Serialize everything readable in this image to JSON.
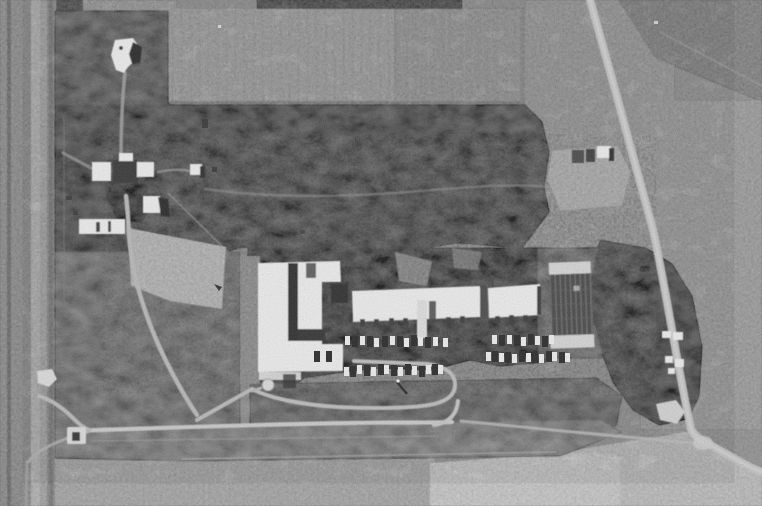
{
  "meta": {
    "kind": "black-and-white vertical aerial photograph",
    "subject": "rural installation with building complex, access roads, fields and a diagonal highway",
    "width_px": 762,
    "height_px": 506
  },
  "palette": {
    "base_field": "#8c8c8c",
    "left_margin": "#7d7d7d",
    "tilled_field": "#949494",
    "tilled_field_east": "#898989",
    "top_right_corner": "#757575",
    "scrub": "#474747",
    "scrub_light": "#545454",
    "building_ground": "#3e3e3e",
    "grass_west": "#656565",
    "grass_band": "#717171",
    "plowed_left": "#999999",
    "plowed_bright": "#bcbcbc",
    "plowed_right": "#b0b0b0",
    "cleared": "#a6a6a6",
    "pad": "#9b9b9b",
    "road": "#c6c6c6",
    "highway": "#bdbdbd",
    "white": "#ececec",
    "shadow": "#1c1c1c",
    "court_dark": "#383838",
    "court_bar": "#d2d2d2"
  },
  "features": {
    "photo": "black-and-white aerial photograph, no visible text",
    "water_tower": "white water tower with dark shadow, upper left",
    "north_field": "large cultivated field with faint vertical plough lines, top centre",
    "scrub_belt": "dark belt of scrub and trees across the upper middle",
    "west_compound": "cluster of small white buildings with shadows, left of centre",
    "cleared_patch": "light cleared ground below the west compound",
    "main_building": "large white L-shaped building with dark internal shadows, centre",
    "long_buildings": "two long white-roofed buildings east of the main building",
    "parking_rows": "rows of light and dark vehicles parked south of the buildings",
    "storage_tank": "small round white tank beside the parking loop",
    "loop_drive": "looping driveway with U-turn serving the parking rows",
    "entrance_road": "east-west entrance road along the south side with gate structure at its west end",
    "court": "rectangular court or bleacher structure with white end bars",
    "tree_grove": "dark tree grove in the south-east quadrant with small white sheds",
    "ne_compound": "small fenced pad with two buildings, upper right",
    "highway": "light diagonal highway from top centre to lower right, bending east near the bottom",
    "south_fields": "light ploughed fields along the bottom edge",
    "west_track": "vertical track and fence lines along the left edge"
  },
  "vehicles": {
    "car_w": 5,
    "car_h": 9,
    "truck_w": 6,
    "truck_h": 11,
    "white": "#eeeeee",
    "dark": "#161616",
    "rows": [
      {
        "y": 337,
        "white_x": [
          345,
          360,
          374,
          390,
          404,
          418,
          433,
          443
        ],
        "dark_x": [
          352,
          367,
          382,
          397,
          411,
          425
        ]
      },
      {
        "y": 366,
        "white_x": [
          344,
          357,
          371,
          384,
          398,
          412,
          426,
          438
        ],
        "dark_x": [
          350,
          364,
          378,
          391,
          405,
          419,
          432
        ]
      },
      {
        "y": 353,
        "white_x": [
          486,
          499,
          512,
          526,
          539,
          552,
          565
        ],
        "dark_x": [
          492,
          505,
          519,
          532,
          546,
          559
        ]
      },
      {
        "y": 336,
        "white_x": [
          492,
          507,
          521,
          535,
          549
        ],
        "dark_x": [
          499,
          514,
          528,
          542
        ]
      },
      {
        "y": 351,
        "white_x": [
          308,
          320,
          332
        ],
        "dark_x": [
          314,
          326
        ]
      }
    ]
  }
}
